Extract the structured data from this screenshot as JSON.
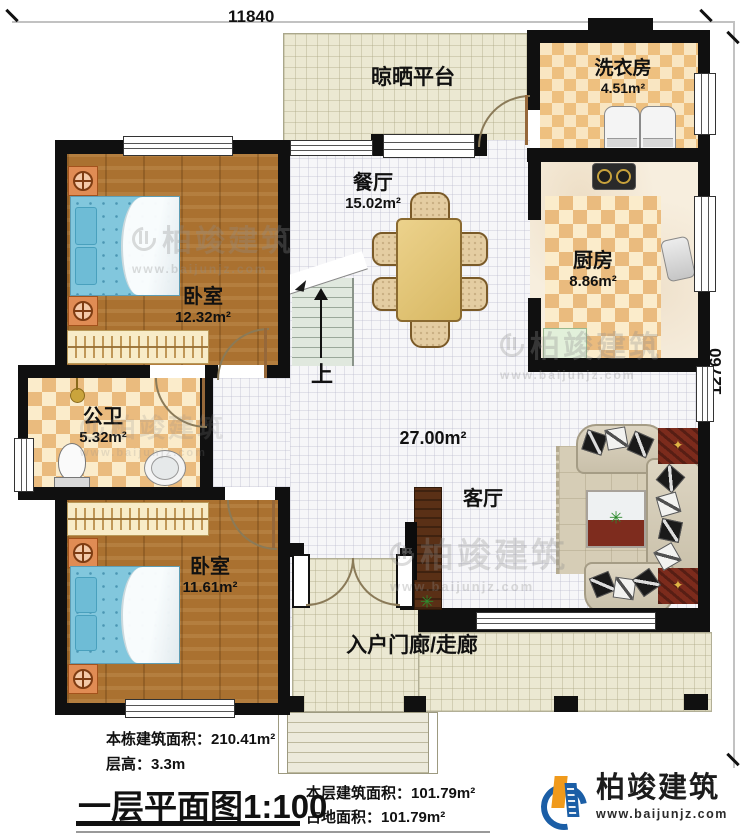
{
  "dimensions": {
    "top_width": "11840",
    "right_height": "12760"
  },
  "rooms": {
    "drying_platform": {
      "name": "晾晒平台"
    },
    "laundry": {
      "name": "洗衣房",
      "area": "4.51m²"
    },
    "kitchen": {
      "name": "厨房",
      "area": "8.86m²"
    },
    "dining": {
      "name": "餐厅",
      "area": "15.02m²"
    },
    "bedroom_top": {
      "name": "卧室",
      "area": "12.32m²"
    },
    "bathroom": {
      "name": "公卫",
      "area": "5.32m²"
    },
    "bedroom_bottom": {
      "name": "卧室",
      "area": "11.61m²"
    },
    "living": {
      "name": "客厅",
      "area": "27.00m²"
    },
    "porch": {
      "name": "入户门廊/走廊"
    },
    "stairs": {
      "up": "上"
    }
  },
  "footer": {
    "building_area_label": "本栋建筑面积：",
    "building_area_value": "210.41m²",
    "floor_height_label": "层高：",
    "floor_height_value": "3.3m",
    "plan_title": "一层平面图",
    "plan_scale": "1:100",
    "floor_area_label": "本层建筑面积：",
    "floor_area_value": "101.79m²",
    "ground_area_label": "占地面积：",
    "ground_area_value": "101.79m²"
  },
  "brand": {
    "name": "柏竣建筑",
    "website": "www.baijunjz.com"
  }
}
